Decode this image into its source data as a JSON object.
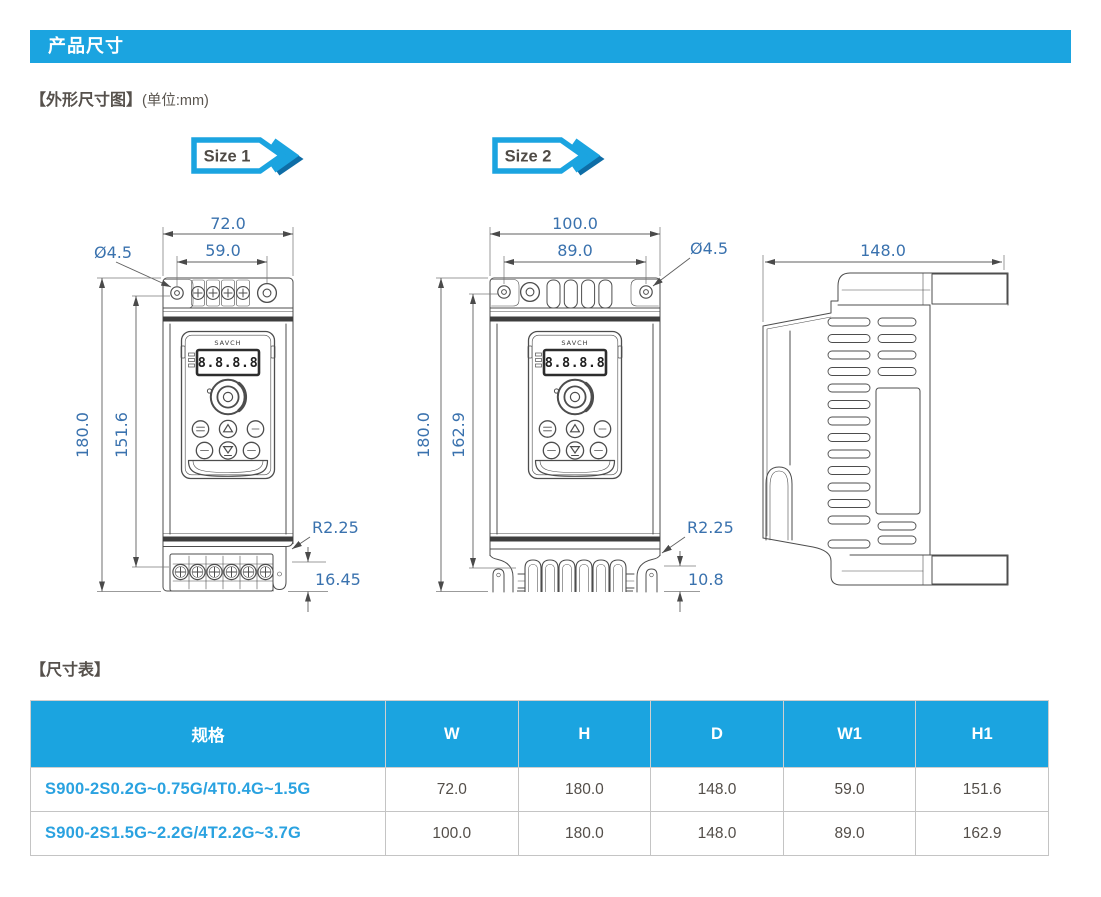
{
  "header": {
    "title": "产品尺寸"
  },
  "section1": {
    "heading": "【外形尺寸图】",
    "unit": "(单位:mm)"
  },
  "badges": {
    "size1": "Size 1",
    "size2": "Size 2"
  },
  "device": {
    "brand": "SAVCH",
    "display": "8.8.8.8"
  },
  "dims": {
    "size1": {
      "w": "72.0",
      "w1": "59.0",
      "hole": "Ø4.5",
      "h": "180.0",
      "h1": "151.6",
      "r": "R2.25",
      "t": "16.45"
    },
    "size2": {
      "w": "100.0",
      "w1": "89.0",
      "hole": "Ø4.5",
      "h": "180.0",
      "h1": "162.9",
      "r": "R2.25",
      "t": "10.8"
    },
    "side": {
      "d": "148.0"
    }
  },
  "section2": {
    "heading": "【尺寸表】"
  },
  "table": {
    "headers": [
      "规格",
      "W",
      "H",
      "D",
      "W1",
      "H1"
    ],
    "rows": [
      {
        "spec": "S900-2S0.2G~0.75G/4T0.4G~1.5G",
        "w": "72.0",
        "h": "180.0",
        "d": "148.0",
        "w1": "59.0",
        "h1": "151.6"
      },
      {
        "spec": "S900-2S1.5G~2.2G/4T2.2G~3.7G",
        "w": "100.0",
        "h": "180.0",
        "d": "148.0",
        "w1": "89.0",
        "h1": "162.9"
      }
    ]
  },
  "colors": {
    "accent_blue": "#1ba4e0",
    "badge_shadow_blue": "#0e6da6",
    "dim_label_blue": "#3a72ae",
    "spec_text_blue": "#2aa2e0",
    "body_text_gray": "#534e49",
    "drawing_line_gray": "#4d4d4d"
  }
}
